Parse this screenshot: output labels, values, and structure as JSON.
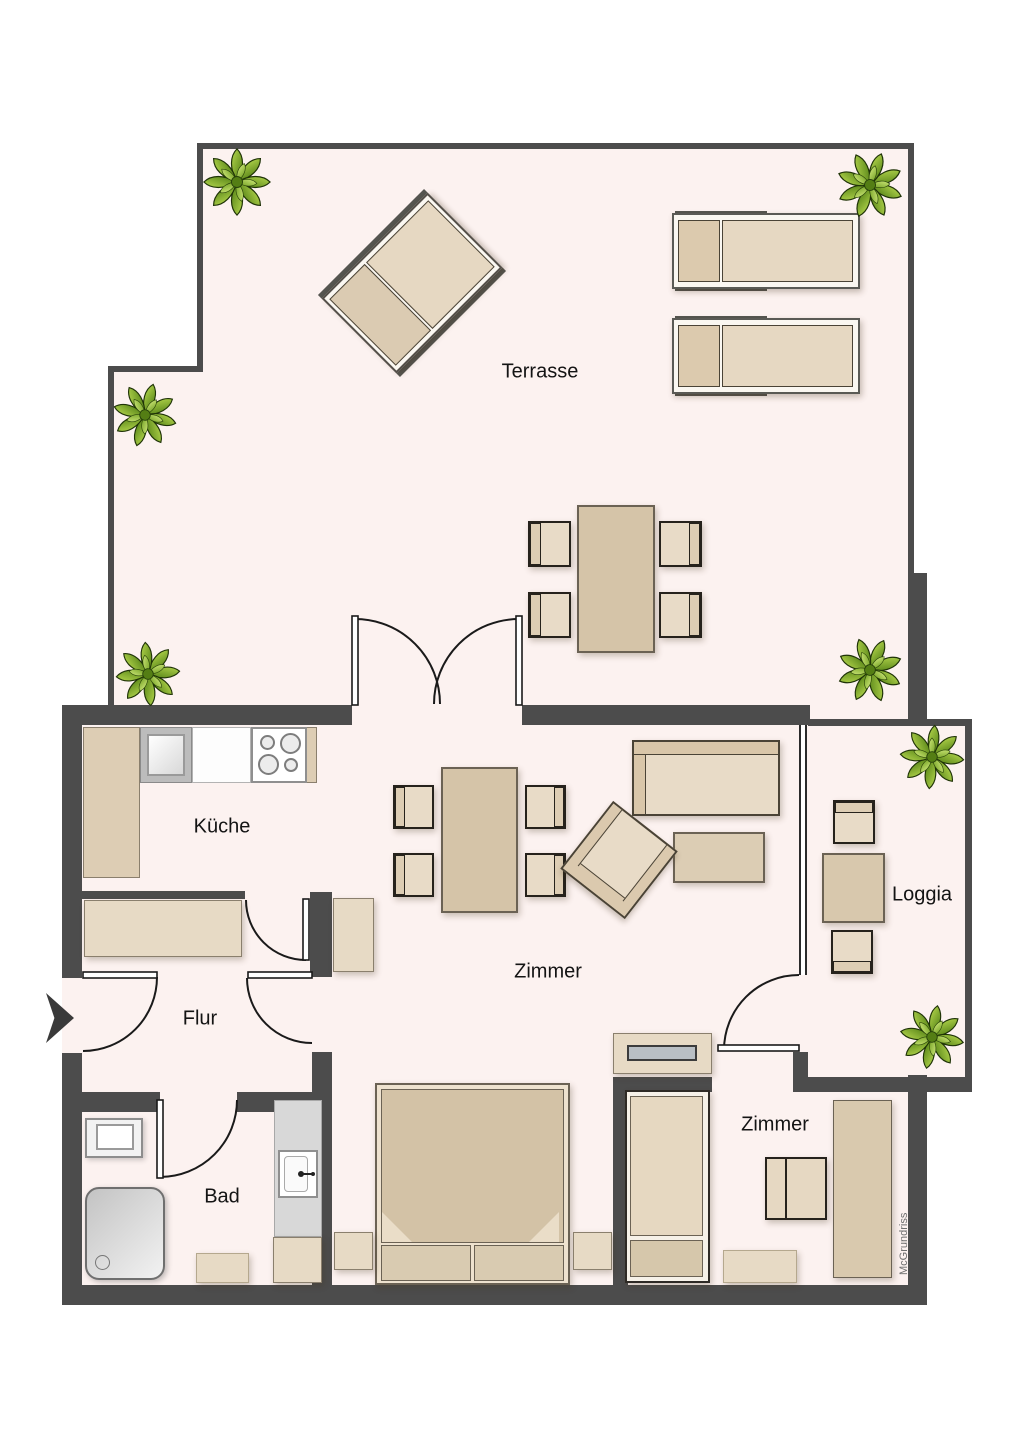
{
  "watermark": "McGrundriss",
  "rooms": {
    "terrasse": "Terrasse",
    "kueche": "Küche",
    "flur": "Flur",
    "bad": "Bad",
    "zimmer_living": "Zimmer",
    "loggia": "Loggia",
    "zimmer_bedroom": "Zimmer"
  },
  "colors": {
    "wall": "#4c4c4c",
    "floor": "#fcf2f0",
    "furniture_light": "#e8dbc7",
    "furniture_tan": "#d5c4a8",
    "plant_green": "#7fae2a",
    "tv_screen_gray": "#b9bfc4"
  }
}
